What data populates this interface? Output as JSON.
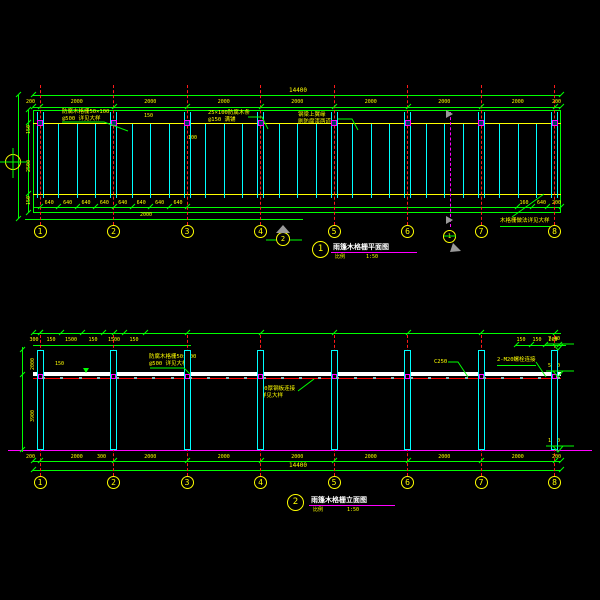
{
  "plan": {
    "no": "1",
    "title": "雨篷木格栅平面图",
    "scale_label": "比例",
    "scale": "1:50",
    "grids": [
      "1",
      "2",
      "3",
      "4",
      "5",
      "6",
      "7",
      "8"
    ],
    "overall": "14400",
    "bays": [
      "200",
      "2000",
      "2000",
      "2000",
      "2000",
      "2000",
      "2000",
      "2000",
      "200"
    ],
    "small_dims": [
      "640",
      "640",
      "640",
      "640",
      "640",
      "640",
      "640",
      "640"
    ],
    "small_dims_right": [
      "160",
      "640",
      "200"
    ],
    "bottom_dim": "2000",
    "left_dims": [
      "150",
      "2500",
      "150"
    ],
    "tiny1": "150",
    "tiny2": "100",
    "view_no": "2",
    "section_no": "1",
    "notes": {
      "n1a": "防腐木格栅50×100",
      "n1b": "@500 详见大样",
      "n2a": "25×100防腐木条",
      "n2b": "@150 满铺",
      "n3a": "钢梁上翼缘",
      "n3b": "刷防腐漆两道",
      "n4": "木格栅做法详见大样"
    }
  },
  "elev": {
    "no": "2",
    "title": "雨篷木格栅立面图",
    "scale_label": "比例",
    "scale": "1:50",
    "grids": [
      "1",
      "2",
      "3",
      "4",
      "5",
      "6",
      "7",
      "8"
    ],
    "overall": "14400",
    "bays": [
      "200",
      "2000",
      "2000",
      "2000",
      "2000",
      "2000",
      "2000",
      "2000",
      "200"
    ],
    "top_dims": [
      "300",
      "150",
      "1500",
      "150",
      "1500",
      "150"
    ],
    "top_dims_right": [
      "150",
      "150",
      "200"
    ],
    "levels": [
      "7.40",
      "5.40",
      "1.50"
    ],
    "left_dims": [
      "2000",
      "3900"
    ],
    "bottom_left": "300",
    "notes": {
      "n5a": "防腐木格栅50×100",
      "n5b": "@500 详见大样",
      "n6": "C250",
      "n7": "2-M20螺栓连接",
      "n8a": "10厚钢板连接",
      "n8b": "详见大样",
      "tiny": "150"
    }
  },
  "colors": {
    "grid": "#ff1a1a",
    "dimension": "#00ff00",
    "text": "#ffff00",
    "member": "#00ffff",
    "ground": "#ff00ff",
    "beam": "#ffffff"
  }
}
